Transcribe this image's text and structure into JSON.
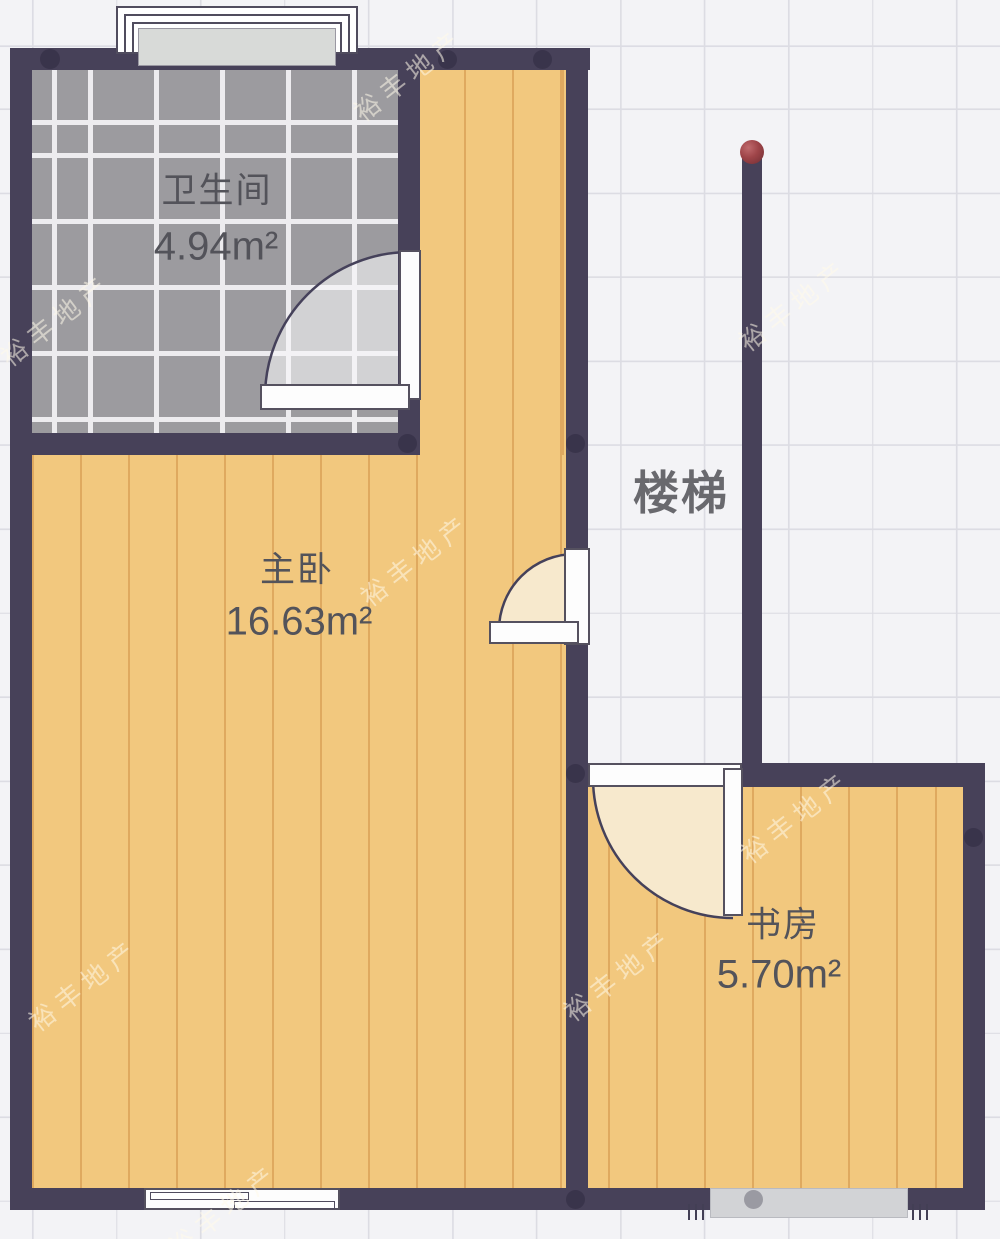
{
  "plan_title": "二层户型图",
  "rooms": {
    "bathroom": {
      "name": "卫生间",
      "area": "4.94m²"
    },
    "bedroom": {
      "name": "主卧",
      "area": "16.63m²"
    },
    "study": {
      "name": "书房",
      "area": "5.70m²"
    },
    "stairs": {
      "name": "楼梯"
    }
  },
  "watermark": {
    "text": "裕丰地产"
  },
  "colors": {
    "wall": "#474159",
    "wood_floor": "#f2c87e",
    "wood_plank_line": "#dfa95f",
    "tile_floor": "#9c9b9f",
    "tile_grout": "#edecef",
    "door_swing_cream": "#f7e9cd",
    "background": "#f3f3f6",
    "grid_line": "#dcdce3",
    "stair_post_red": "#9e4448",
    "label_text": "#53535a"
  }
}
